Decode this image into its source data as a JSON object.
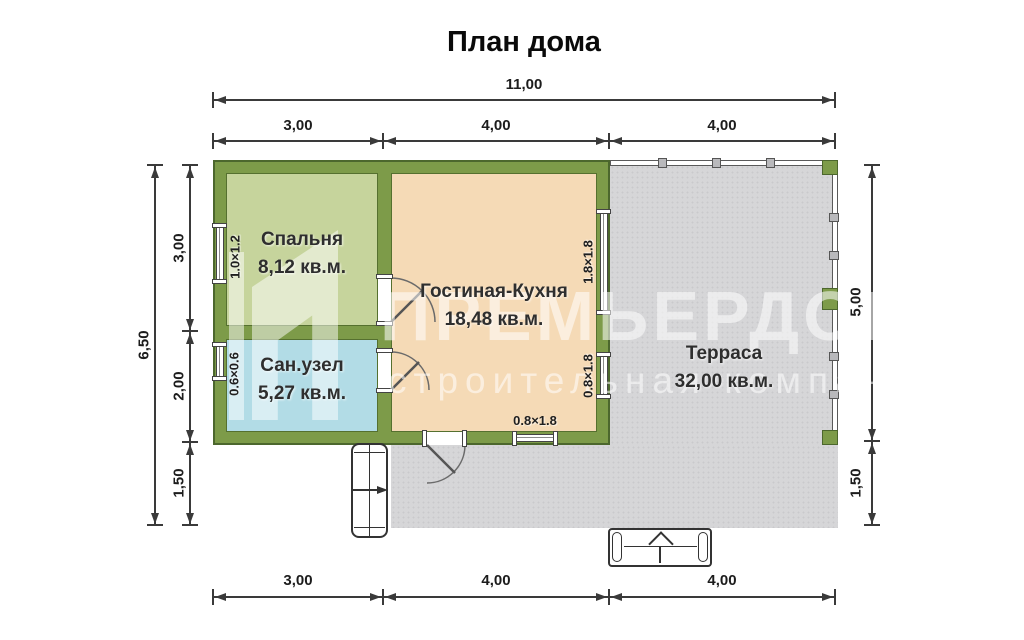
{
  "title": "План дома",
  "watermark": {
    "brand": "ПРЕМЬЕРДОМ",
    "subtitle": "строительная компания"
  },
  "dimensions": {
    "top_total": "11,00",
    "top_segments": [
      "3,00",
      "4,00",
      "4,00"
    ],
    "left_total": "6,50",
    "left_segments": [
      "3,00",
      "2,00",
      "1,50"
    ],
    "right_segments": [
      "5,00",
      "1,50"
    ],
    "bottom_segments": [
      "3,00",
      "4,00",
      "4,00"
    ]
  },
  "rooms": [
    {
      "name": "Спальня",
      "area": "8,12 кв.м."
    },
    {
      "name": "Сан.узел",
      "area": "5,27 кв.м."
    },
    {
      "name": "Гостиная-Кухня",
      "area": "18,48 кв.м."
    },
    {
      "name": "Терраса",
      "area": "32,00 кв.м."
    }
  ],
  "window_labels": [
    "1.0×1.2",
    "0.6×0.6",
    "1.8×1.8",
    "0.8×1.8",
    "0.8×1.8"
  ],
  "colors": {
    "wall": "#7d9b49",
    "wall_outline": "#4c672d",
    "bedroom_fill": "#c6d49c",
    "bathroom_fill": "#b2dce6",
    "living_fill": "#f5dab6",
    "terrace_fill": "#d6d6d8",
    "dimension_line": "#3a3a3a"
  }
}
